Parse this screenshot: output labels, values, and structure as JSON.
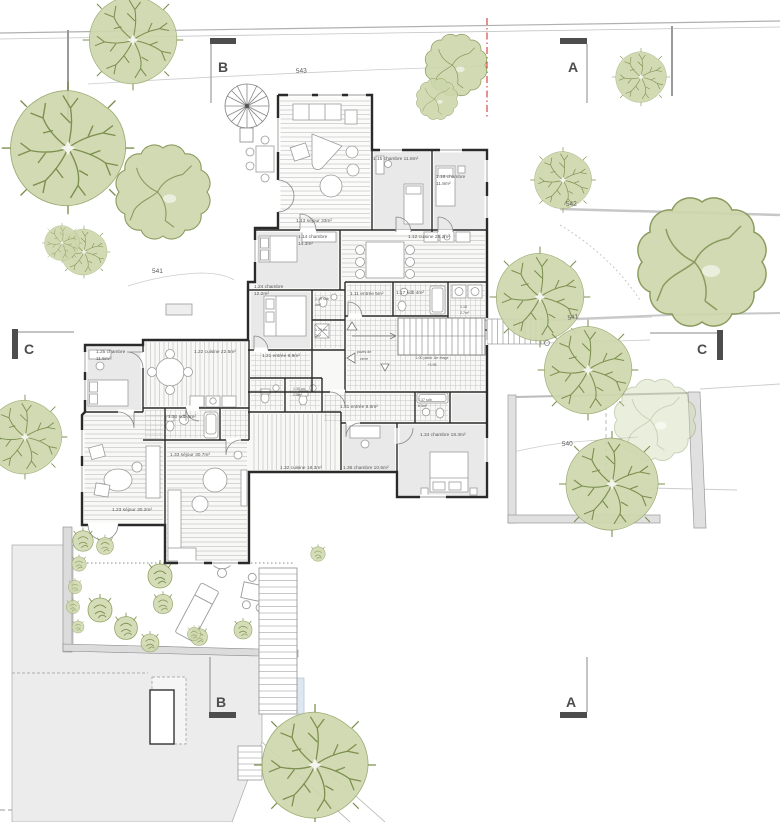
{
  "palette": {
    "wall": "#2a2a2a",
    "tree_fill": "#cdd7ac",
    "tree_stroke": "#7c8f4e",
    "boundary_red": "#cc2222",
    "marker_gray": "#4d4d4d",
    "site_line": "#c2c2c2"
  },
  "markers": {
    "b_top": "B",
    "a_top": "A",
    "c_left": "C",
    "c_right": "C",
    "b_bottom": "B",
    "a_bottom": "A"
  },
  "contours": {
    "l543": "543",
    "l541_left": "541",
    "l542": "542",
    "l541_right": "541",
    "l540": "540"
  },
  "rooms": {
    "r13": {
      "l1": "1.13 séjour 33m²"
    },
    "r14": {
      "l1": "1.14 chambre",
      "l2": "14.3m²"
    },
    "r15": {
      "l1": "1.15 chambre 11.8m²"
    },
    "r16": {
      "l1": "1.16 chambre",
      "l2": "11.8m²"
    },
    "r12": {
      "l1": "1.12 cuisine 28.2m²"
    },
    "r24": {
      "l1": "1.24 chambre",
      "l2": "12.2m²"
    },
    "r11": {
      "l1": "1.11 entrée 5m²"
    },
    "r17": {
      "l1": "1.17 sdb 4m²"
    },
    "r18": {
      "l1": "1.18",
      "l2": "2.7m²"
    },
    "r19": {
      "l1": "1.19 sdb",
      "l2": "4m²"
    },
    "r20": {
      "l1": "1.20 wc",
      "l2": "2m²"
    },
    "r21": {
      "l1": "1.21 entrée 8.9m²"
    },
    "r25": {
      "l1": "1.25 chambre",
      "l2": "11.5m²"
    },
    "r22": {
      "l1": "1.22 cuisine 22.5m²"
    },
    "r30": {
      "l1": "1.30 sdb 5m²"
    },
    "r33": {
      "l1": "1.33 séjour 30.7m²"
    },
    "r23": {
      "l1": "1.23 séjour 30.2m²"
    },
    "r31": {
      "l1": "1.31 entrée 8.8m²"
    },
    "r32": {
      "l1": "1.32 cuisine 18.3m²"
    },
    "r36": {
      "l1": "1.36 chambre 10.5m²"
    },
    "r34": {
      "l1": "1.34 chambre 18.3m²"
    },
    "r37": {
      "l1": "1.37 sdb",
      "l2": "6.5m²"
    },
    "r35": {
      "l1": "1.35 wc",
      "l2": "2.5m²"
    }
  },
  "annotations": {
    "palier": {
      "l1": "1.00 palier 1er étage",
      "l2": "+3.95"
    },
    "paves": {
      "l1": "pavés de",
      "l2": "verre"
    }
  }
}
